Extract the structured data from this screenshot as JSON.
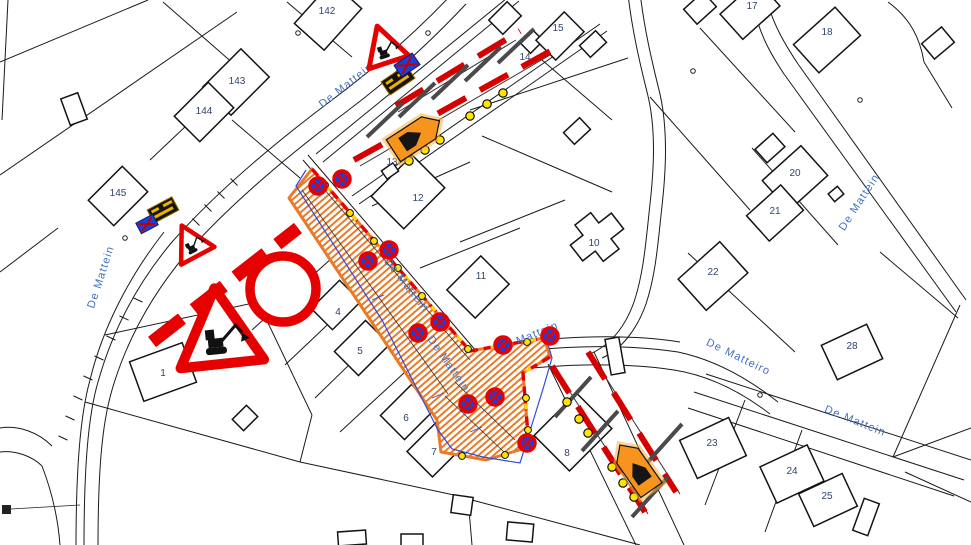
{
  "meta": {
    "width": 971,
    "height": 545,
    "description": "Road works traffic control plan (cadastral situation drawing) for street De Mattein: excavation trench, road closure signs, barrier fences with lamps and arrow boards"
  },
  "palette": {
    "line": "#1a1a1a",
    "red": "#E60000",
    "orange": "#F7941D",
    "trench_orange": "#E87A28",
    "yellow": "#FFE400",
    "blue_outline": "#2F4BDC",
    "sign_blue": "#1E3ED8",
    "street_text": "#4070C0",
    "parcel_text": "#31446C",
    "gray_post": "#4A4A4A",
    "dark_sign": "#1A1206",
    "sign_yellow": "#E8B400"
  },
  "street_labels": [
    {
      "label": "De Mattein",
      "x": 348,
      "y": 88,
      "rot": -38
    },
    {
      "label": "De Mattein",
      "x": 104,
      "y": 278,
      "rot": -72
    },
    {
      "label": "De Mattein",
      "x": 404,
      "y": 287,
      "rot": 52
    },
    {
      "label": "De Mattein",
      "x": 446,
      "y": 366,
      "rot": 55
    },
    {
      "label": "De Mattein",
      "x": 529,
      "y": 340,
      "rot": -22
    },
    {
      "label": "De Mattein",
      "x": 862,
      "y": 204,
      "rot": -57
    },
    {
      "label": "De Matteiro",
      "x": 737,
      "y": 360,
      "rot": 26
    },
    {
      "label": "De Mattein",
      "x": 854,
      "y": 424,
      "rot": 22
    }
  ],
  "parcel_labels": [
    {
      "label": "142",
      "x": 327,
      "y": 14
    },
    {
      "label": "143",
      "x": 237,
      "y": 84
    },
    {
      "label": "144",
      "x": 204,
      "y": 114
    },
    {
      "label": "145",
      "x": 118,
      "y": 196
    },
    {
      "label": "15",
      "x": 558,
      "y": 31
    },
    {
      "label": "14",
      "x": 525,
      "y": 60
    },
    {
      "label": "13",
      "x": 392,
      "y": 165
    },
    {
      "label": "12",
      "x": 418,
      "y": 201
    },
    {
      "label": "11",
      "x": 481,
      "y": 279
    },
    {
      "label": "10",
      "x": 594,
      "y": 246
    },
    {
      "label": "17",
      "x": 752,
      "y": 9
    },
    {
      "label": "18",
      "x": 827,
      "y": 35
    },
    {
      "label": "20",
      "x": 795,
      "y": 176
    },
    {
      "label": "21",
      "x": 775,
      "y": 214
    },
    {
      "label": "22",
      "x": 713,
      "y": 275
    },
    {
      "label": "28",
      "x": 852,
      "y": 349
    },
    {
      "label": "23",
      "x": 712,
      "y": 446
    },
    {
      "label": "24",
      "x": 792,
      "y": 474
    },
    {
      "label": "25",
      "x": 827,
      "y": 499
    },
    {
      "label": "8",
      "x": 567,
      "y": 456
    },
    {
      "label": "7",
      "x": 434,
      "y": 455
    },
    {
      "label": "6",
      "x": 406,
      "y": 421
    },
    {
      "label": "5",
      "x": 360,
      "y": 354
    },
    {
      "label": "4",
      "x": 338,
      "y": 315
    },
    {
      "label": "1",
      "x": 163,
      "y": 376
    }
  ],
  "map": {
    "roads": [
      "M452,-6 C420,28 380,64 332,100 C272,145 216,192 172,242 C136,285 112,332 98,382 C88,416 84,468 84,548",
      "M466,4 C434,38 394,76 346,112 C286,157 230,204 186,254 C150,297 126,342 112,390 C102,424 98,470 98,548",
      "M76,548 C76,470 80,416 90,380 C102,330 128,278 164,232",
      "M316,154 L512,-6",
      "M323,162 L519,1",
      "M352,196 L600,24",
      "M359,204 L607,31",
      "M303,160 L472,357 C480,368 492,374 505,371",
      "M308,155 L477,352 C486,362 497,367 510,366",
      "M505,371 C560,364 622,362 674,370 C712,376 744,394 770,414",
      "M512,352 C566,346 626,344 678,352 C716,360 750,380 778,402",
      "M518,342 C572,336 630,334 680,342",
      "M694,392 L964,480",
      "M706,374 L971,460",
      "M688,408 L954,496",
      "M798,64 L966,300",
      "M784,74 L956,312",
      "M798,64 C786,46 774,26 768,4",
      "M784,74 C772,56 760,36 754,8",
      "M628,-6 C632,30 640,64 648,96 C656,130 654,168 650,204 C646,240 644,272 634,302 C624,330 608,346 590,354",
      "M640,-8 C644,28 652,62 660,94 C668,130 666,170 662,206 C658,242 656,274 646,304 C636,332 620,350 602,358",
      "M548,364 L636,545",
      "M594,352 L684,545",
      "M0,428 C18,425 38,432 52,446",
      "M0,452 C15,450 32,456 42,466",
      "M42,466 C52,492 58,518 60,545"
    ],
    "parcel_lines": [
      [
        0,
        62,
        148,
        0
      ],
      [
        0,
        175,
        237,
        12
      ],
      [
        287,
        2,
        352,
        57
      ],
      [
        163,
        2,
        243,
        72
      ],
      [
        243,
        72,
        150,
        160
      ],
      [
        232,
        120,
        300,
        178
      ],
      [
        58,
        228,
        0,
        272
      ],
      [
        105,
        335,
        258,
        302
      ],
      [
        258,
        302,
        312,
        415
      ],
      [
        312,
        415,
        300,
        462
      ],
      [
        85,
        402,
        300,
        462
      ],
      [
        300,
        462,
        468,
        498
      ],
      [
        468,
        498,
        472,
        545
      ],
      [
        472,
        500,
        640,
        545
      ],
      [
        332,
        258,
        252,
        330
      ],
      [
        362,
        292,
        285,
        365
      ],
      [
        390,
        325,
        315,
        398
      ],
      [
        418,
        360,
        340,
        432
      ],
      [
        372,
        206,
        470,
        162
      ],
      [
        420,
        268,
        520,
        228
      ],
      [
        460,
        242,
        565,
        200
      ],
      [
        470,
        110,
        628,
        58
      ],
      [
        542,
        60,
        612,
        120
      ],
      [
        482,
        136,
        612,
        192
      ],
      [
        650,
        97,
        750,
        210
      ],
      [
        700,
        28,
        795,
        132
      ],
      [
        752,
        148,
        838,
        245
      ],
      [
        688,
        253,
        795,
        352
      ],
      [
        880,
        252,
        958,
        318
      ],
      [
        960,
        305,
        893,
        457
      ],
      [
        745,
        400,
        705,
        505
      ],
      [
        802,
        430,
        765,
        532
      ],
      [
        893,
        457,
        971,
        428
      ],
      [
        905,
        472,
        971,
        502
      ],
      [
        924,
        62,
        952,
        108
      ],
      [
        8,
        0,
        2,
        120
      ]
    ],
    "boundary_curves": [
      "M888,2 C910,18 920,38 924,62"
    ],
    "curb_ticks": [
      [
        63,
        438,
        25
      ],
      [
        70,
        418,
        25
      ],
      [
        78,
        398,
        25
      ],
      [
        88,
        378,
        25
      ],
      [
        99,
        358,
        25
      ],
      [
        111,
        338,
        25
      ],
      [
        124,
        318,
        25
      ],
      [
        138,
        300,
        25
      ],
      [
        196,
        222,
        45
      ],
      [
        208,
        208,
        45
      ],
      [
        221,
        195,
        45
      ],
      [
        234,
        182,
        45
      ]
    ],
    "survey_points": [
      [
        125,
        238
      ],
      [
        298,
        33
      ],
      [
        428,
        33
      ],
      [
        693,
        71
      ],
      [
        760,
        395
      ],
      [
        860,
        100
      ]
    ],
    "buildings": {
      "rects": [
        [
          328,
          16,
          56,
          40,
          -48
        ],
        [
          236,
          82,
          54,
          40,
          -45
        ],
        [
          204,
          112,
          48,
          36,
          -45
        ],
        [
          118,
          196,
          48,
          36,
          -45
        ],
        [
          74,
          109,
          18,
          28,
          -20
        ],
        [
          505,
          18,
          26,
          20,
          -45
        ],
        [
          532,
          42,
          18,
          14,
          -45
        ],
        [
          560,
          36,
          40,
          28,
          -45
        ],
        [
          593,
          44,
          22,
          16,
          -43
        ],
        [
          577,
          131,
          22,
          16,
          -43
        ],
        [
          700,
          8,
          26,
          20,
          -42
        ],
        [
          938,
          43,
          26,
          20,
          -40
        ],
        [
          408,
          192,
          58,
          46,
          -45
        ],
        [
          390,
          171,
          14,
          10,
          -35
        ],
        [
          478,
          287,
          48,
          40,
          -45
        ],
        [
          336,
          305,
          40,
          30,
          -45
        ],
        [
          362,
          348,
          44,
          34,
          -45
        ],
        [
          408,
          412,
          44,
          34,
          -45
        ],
        [
          436,
          448,
          46,
          36,
          -45
        ],
        [
          573,
          432,
          60,
          50,
          -45
        ],
        [
          163,
          372,
          56,
          42,
          -20
        ],
        [
          245,
          418,
          20,
          16,
          -45
        ],
        [
          827,
          40,
          56,
          38,
          -42
        ],
        [
          750,
          10,
          50,
          34,
          -42
        ],
        [
          770,
          148,
          24,
          18,
          -42
        ],
        [
          795,
          178,
          52,
          40,
          -42
        ],
        [
          775,
          213,
          46,
          34,
          -42
        ],
        [
          713,
          276,
          56,
          42,
          -42
        ],
        [
          852,
          352,
          50,
          38,
          -25
        ],
        [
          713,
          448,
          54,
          42,
          -25
        ],
        [
          792,
          474,
          52,
          40,
          -25
        ],
        [
          828,
          500,
          48,
          36,
          -25
        ],
        [
          866,
          517,
          16,
          34,
          20
        ],
        [
          615,
          356,
          14,
          36,
          -10
        ],
        [
          462,
          505,
          20,
          18,
          8
        ],
        [
          520,
          532,
          26,
          18,
          5
        ],
        [
          352,
          538,
          28,
          14,
          -4
        ],
        [
          412,
          540,
          22,
          12,
          0
        ],
        [
          836,
          194,
          12,
          10,
          -40
        ]
      ],
      "plus_building": {
        "x": 597,
        "y": 237,
        "rot": -38,
        "pts": [
          [
            -26,
            -10
          ],
          [
            -10,
            -10
          ],
          [
            -10,
            -23
          ],
          [
            10,
            -23
          ],
          [
            10,
            -10
          ],
          [
            26,
            -10
          ],
          [
            26,
            10
          ],
          [
            10,
            10
          ],
          [
            10,
            23
          ],
          [
            -10,
            23
          ],
          [
            -10,
            10
          ],
          [
            -26,
            10
          ]
        ]
      }
    }
  },
  "trench": {
    "outline": "M312,169 L470,351 L544,338 L550,357 L523,373 L529,447 L486,460 L441,452 L437,420 L289,198 Z",
    "inner_lines": [
      "M318,182 L470,360",
      "M302,190 L448,394",
      "M455,382 L515,440",
      "M445,396 L504,452"
    ],
    "barrier_edges": [
      "M312,169 L470,351 L544,338",
      "M550,357 L523,373 L529,447"
    ],
    "lamps": [
      [
        325,
        185
      ],
      [
        350,
        213
      ],
      [
        374,
        241
      ],
      [
        398,
        268
      ],
      [
        422,
        296
      ],
      [
        446,
        323
      ],
      [
        468,
        349
      ],
      [
        500,
        347
      ],
      [
        527,
        342
      ],
      [
        526,
        398
      ],
      [
        528,
        430
      ],
      [
        505,
        455
      ],
      [
        462,
        456
      ]
    ],
    "blue_outline": "M306,170 L296,186 L382,320 L438,430 L452,449 L483,457 L520,463 L543,389 L552,358 L546,337",
    "blue_ticks": [
      "M372,300 l12,-5",
      "M432,398 l12,-5",
      "M470,432 l12,-5"
    ]
  },
  "no_stopping_signs": [
    [
      318,
      186
    ],
    [
      342,
      179
    ],
    [
      368,
      261
    ],
    [
      389,
      250
    ],
    [
      418,
      333
    ],
    [
      440,
      322
    ],
    [
      503,
      345
    ],
    [
      550,
      336
    ],
    [
      495,
      397
    ],
    [
      468,
      404
    ],
    [
      527,
      443
    ]
  ],
  "signs": {
    "closure_bars": "M152,342 L298,228",
    "prohibition_circle": {
      "x": 283,
      "y": 289,
      "r": 33
    },
    "roadworks_triangle_large": {
      "x": 219,
      "y": 332,
      "rot": -6,
      "s": 1
    },
    "roadworks_triangles_small": [
      {
        "x": 191,
        "y": 243,
        "rot": -28,
        "s": 0.45
      },
      {
        "x": 384,
        "y": 47,
        "rot": -18,
        "s": 0.5
      }
    ],
    "detour_dark_signs": [
      {
        "x": 398,
        "y": 80,
        "rot": -34,
        "w": 30,
        "h": 16
      },
      {
        "x": 163,
        "y": 210,
        "rot": -28,
        "w": 28,
        "h": 15
      }
    ],
    "detour_blue_signs": [
      {
        "x": 407,
        "y": 65,
        "rot": -34,
        "w": 22,
        "h": 14
      },
      {
        "x": 147,
        "y": 224,
        "rot": -28,
        "w": 19,
        "h": 12
      }
    ]
  },
  "barriers": [
    {
      "name": "top",
      "reds": [
        "M396,106 L520,31",
        "M354,160 L556,48"
      ],
      "rails": [
        "M398,112 L516,40",
        "M360,166 L550,55"
      ],
      "posts": [
        [
          403,
          103,
          367,
          137
        ],
        [
          435,
          83,
          399,
          117
        ],
        [
          468,
          65,
          432,
          99
        ],
        [
          501,
          47,
          465,
          81
        ],
        [
          534,
          29,
          498,
          63
        ]
      ],
      "lamps": [
        [
          409,
          161
        ],
        [
          425,
          150
        ],
        [
          440,
          140
        ],
        [
          470,
          116
        ],
        [
          487,
          104
        ],
        [
          503,
          93
        ]
      ],
      "board": {
        "x": 416,
        "y": 136,
        "rot": -33
      }
    },
    {
      "name": "bottom",
      "reds": [
        "M552,366 L645,512",
        "M588,352 L676,492"
      ],
      "rails": [
        "M556,370 L648,514",
        "M592,356 L680,494"
      ],
      "posts": [
        [
          555,
          417,
          591,
          377
        ],
        [
          582,
          451,
          618,
          411
        ],
        [
          632,
          517,
          668,
          477
        ],
        [
          646,
          464,
          682,
          424
        ]
      ],
      "lamps": [
        [
          567,
          402
        ],
        [
          579,
          419
        ],
        [
          588,
          433
        ],
        [
          612,
          467
        ],
        [
          623,
          483
        ],
        [
          634,
          497
        ]
      ],
      "board": {
        "x": 636,
        "y": 468,
        "rot": -125
      }
    }
  ],
  "misc": {
    "corner_marker": {
      "rect": [
        2,
        505,
        9,
        9
      ],
      "leader": "M11,509 L80,505"
    }
  }
}
